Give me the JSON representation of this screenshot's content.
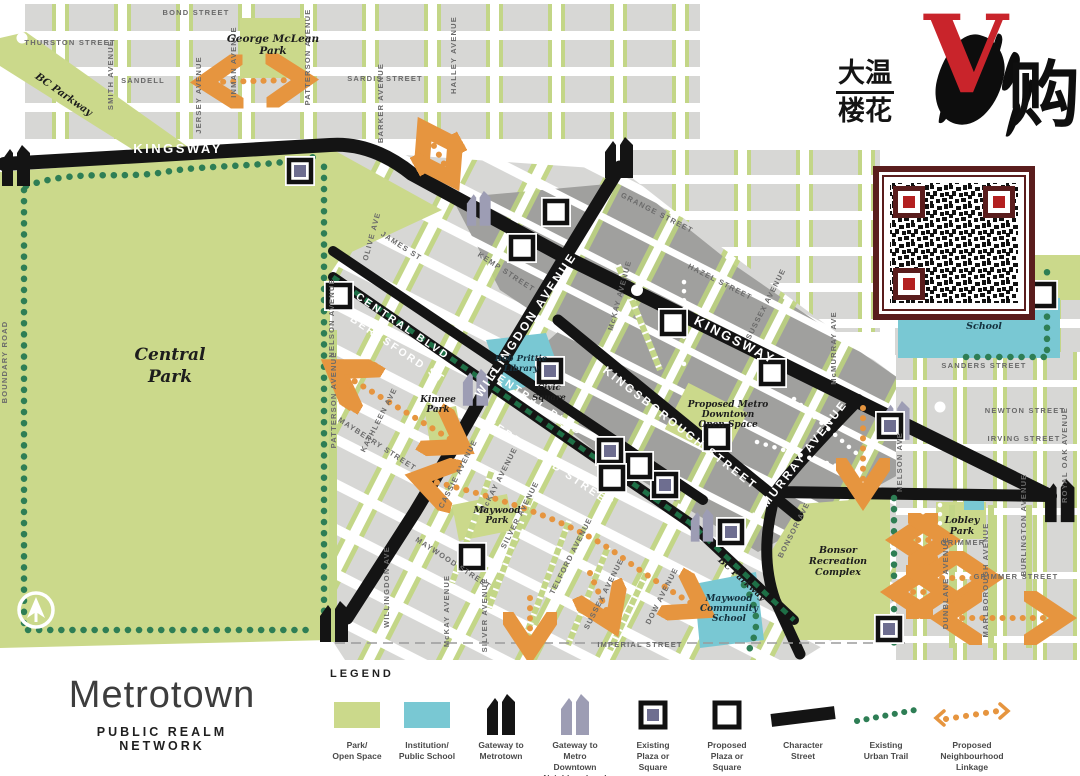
{
  "branding": {
    "line1": "大温",
    "line2": "楼花",
    "v": "V",
    "right": "购"
  },
  "title": {
    "main": "Metrotown",
    "subtitle": "PUBLIC REALM NETWORK"
  },
  "legend": {
    "heading": "LEGEND",
    "items": [
      {
        "id": "park-open-space",
        "label": [
          "Park/",
          "Open Space"
        ]
      },
      {
        "id": "institution-public-school",
        "label": [
          "Institution/",
          "Public School"
        ]
      },
      {
        "id": "gateway-to-metrotown",
        "label": [
          "Gateway to",
          "Metrotown"
        ]
      },
      {
        "id": "gateway-to-metro-downtown",
        "label": [
          "Gateway to",
          "Metro",
          "Downtown",
          "Neighbourhood"
        ]
      },
      {
        "id": "existing-plaza-or-square",
        "label": [
          "Existing",
          "Plaza or",
          "Square"
        ]
      },
      {
        "id": "proposed-plaza-or-square",
        "label": [
          "Proposed",
          "Plaza or",
          "Square"
        ]
      },
      {
        "id": "character-street",
        "label": [
          "Character",
          "Street"
        ]
      },
      {
        "id": "existing-urban-trail",
        "label": [
          "Existing",
          "Urban Trail"
        ]
      },
      {
        "id": "proposed-neighbourhood-linkage",
        "label": [
          "Proposed",
          "Neighbourhood",
          "Linkage"
        ]
      }
    ]
  },
  "colors": {
    "park": "#cbd98b",
    "institution": "#79c8d3",
    "road": "#141414",
    "block": "#d7d7d5",
    "block_dark": "#a0a09e",
    "street_green": "#c3d687",
    "trail": "#2e7e55",
    "linkage": "#e6953f",
    "plaza_fill": "#6e6e90",
    "qr_border": "#5a1d1d",
    "qr_finder": "#b32020",
    "brand_red": "#c9242b"
  },
  "map": {
    "roads": {
      "kingsway_w": "KINGSWAY",
      "kingsway_e": "KINGSWAY",
      "central_1": "CENTRAL BLVD",
      "beresford_1": "BERESFORD ST",
      "central_2": "CENTRAL BLVD",
      "beresford_2": "BERESFORD STREET",
      "willingdon": "WILLINGDON AVENUE",
      "kingsborough": "KINGSBOROUGH STREET",
      "mcmurray": "McMURRAY AVENUE"
    },
    "streets": {
      "bond": "BOND STREET",
      "thurston": "THURSTON STREET",
      "sandell": "SANDELL",
      "smith": "SMITH AVENUE",
      "jersey": "JERSEY AVENUE",
      "inman": "INMAN AVENUE",
      "patterson_n": "PATTERSON AVENUE",
      "sardis": "SARDIS STREET",
      "barker_n": "BARKER AVENUE",
      "halley": "HALLEY AVENUE",
      "boundary": "BOUNDARY ROAD",
      "patterson_s": "PATTERSON AVENUE",
      "grange": "GRANGE STREET",
      "hazel": "HAZEL STREET",
      "sussex_n": "SUSSEX AVENUE",
      "mckay_n": "McKAY AVENUE",
      "kemp": "KEMP STREET",
      "james": "JAMES ST",
      "olive": "OLIVE AVE",
      "nelson_w": "NELSON AVENUE",
      "mcmurray_small": "McMURRAY AVE",
      "mayberry": "MAYBERRY STREET",
      "kathleen": "KATHLEEN AVE",
      "cassie": "CASSIE AVENUE",
      "mckay_c": "McKAY AVENUE",
      "silver_c": "SILVER AVENUE",
      "telford": "TELFORD AVENUE",
      "sussex_s": "SUSSEX AVENUE",
      "dow": "DOW AVENUE",
      "maywood_st": "MAYWOOD STREET",
      "willingdon_s": "WILLINGDON AVE",
      "mckay_s": "McKAY AVENUE",
      "silver_s": "SILVER AVENUE",
      "imperial": "IMPERIAL STREET",
      "bonsor_ave": "BONSOR AVE",
      "grimmer_sm": "GRIMMER",
      "grimmer_st": "GRIMMER STREET",
      "dunblane": "DUNBLANE AVENUE",
      "marlborough": "MARLBOROUGH AVENUE",
      "burlington": "BURLINGTON AVENUE",
      "nelson_e": "NELSON AVE",
      "sanders": "SANDERS STREET",
      "newton": "NEWTON STREET",
      "irving": "IRVING STREET",
      "royal_oak": "ROYAL OAK AVENUE"
    },
    "parks": {
      "central": [
        "Central",
        "Park"
      ],
      "george": [
        "George McLean",
        "Park"
      ],
      "kinnee": [
        "Kinnee",
        "Park"
      ],
      "maywood": [
        "Maywood",
        "Park"
      ],
      "bonsor": [
        "Bonsor",
        "Recreation",
        "Complex"
      ],
      "lobley": [
        "Lobley",
        "Park"
      ],
      "bc_parkway_1": "BC Parkway",
      "bc_parkway_2": "BC Parkway"
    },
    "institutions": {
      "library": [
        "Bob Prittie",
        "Library"
      ],
      "civic": [
        "Civic",
        "Square"
      ],
      "elementary": [
        "Elementary",
        "School"
      ],
      "maywood_school": [
        "Maywood",
        "Community",
        "School"
      ]
    },
    "annotations": {
      "open_space": [
        "Proposed Metro",
        "Downtown",
        "Open Space"
      ]
    }
  }
}
